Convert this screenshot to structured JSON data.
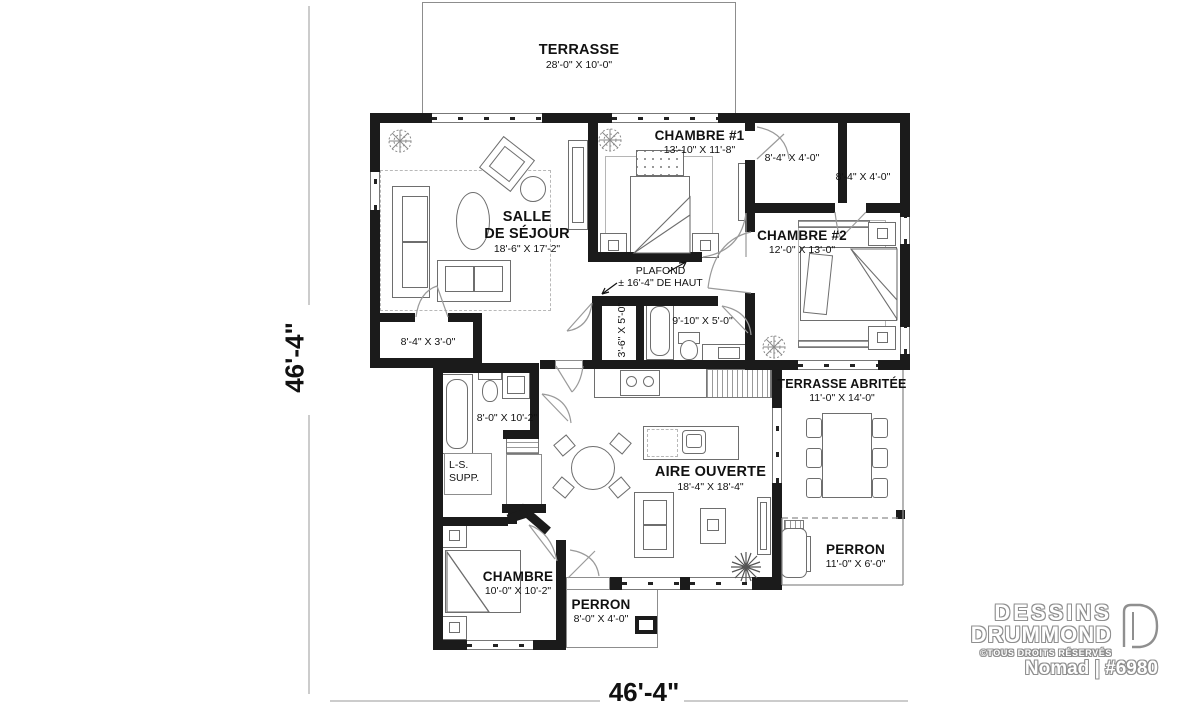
{
  "rooms": {
    "terrasse": {
      "name": "TERRASSE",
      "dim": "28'-0\" X 10'-0\""
    },
    "salle_de_sejour": {
      "name1": "SALLE",
      "name2": "DE SÉJOUR",
      "dim": "18'-6\" X 17'-2\""
    },
    "chambre1": {
      "name": "CHAMBRE #1",
      "dim": "13'-10\" X 11'-8\""
    },
    "walkin1": {
      "dim": "8'-4\" X 4'-0\""
    },
    "walkin2": {
      "dim": "8'-4\" X 4'-0\""
    },
    "chambre2": {
      "name": "CHAMBRE #2",
      "dim": "12'-0\" X 13'-0\""
    },
    "vestiaire": {
      "dim": "8'-4\" X 3'-0\""
    },
    "walkin3": {
      "dim": "3'-6\" X 5'-0\""
    },
    "salle_de_bain": {
      "dim": "9'-10\" X 5'-0\""
    },
    "salle_de_bain2": {
      "dim": "8'-0\" X 10'-2\""
    },
    "aire_ouverte": {
      "name": "AIRE OUVERTE",
      "dim": "18'-4\" X 18'-4\""
    },
    "terrasse_abritee": {
      "name": "TERRASSE ABRITÉE",
      "dim": "11'-0\" X 14'-0\""
    },
    "perron_cote": {
      "name": "PERRON",
      "dim": "11'-0\" X 6'-0\""
    },
    "chambre3": {
      "name": "CHAMBRE",
      "dim": "10'-0\" X 10'-2\""
    },
    "perron_avant": {
      "name": "PERRON",
      "dim": "8'-0\" X 4'-0\""
    }
  },
  "annotations": {
    "plafond1": "PLAFOND",
    "plafond2": "± 16'-4\" DE HAUT",
    "laundry1": "L-S.",
    "laundry2": "SUPP."
  },
  "dimensions": {
    "left": "46'-4\"",
    "bottom": "46'-4\""
  },
  "branding": {
    "line1": "DESSINS",
    "line2": "DRUMMOND",
    "copyright": "©TOUS DROITS RÉSERVÉS",
    "model": "Nomad | #6980"
  },
  "colors": {
    "wall": "#1b1b1b",
    "line": "#8d8d8d",
    "accent": "#777777"
  }
}
